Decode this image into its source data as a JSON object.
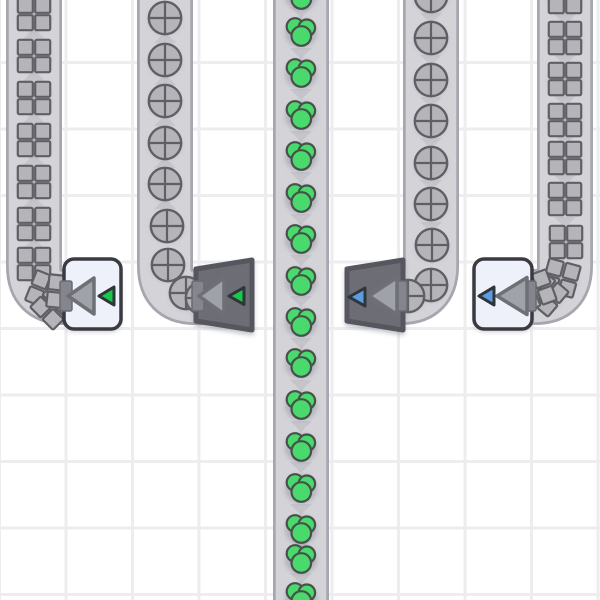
{
  "scene": {
    "name": "conveyor-factory-scene",
    "canvas": {
      "width": 600,
      "height": 600
    },
    "grid": {
      "cell_size": 66.5,
      "line_width": 3,
      "line_color": "#ededf0",
      "cell_color": "#ffffff",
      "offset_x": -2,
      "offset_y": 61
    },
    "colors": {
      "belt_border": "#a6a6ae",
      "belt_surface": "#d3d3d8",
      "chevron": "#c5c5cb",
      "item_gray_fill": "#b5b5b9",
      "item_outline": "#5f5f66",
      "berry_fill": "#49d96d",
      "berry_outline": "#47514a",
      "building_light_fill": "#eef1f9",
      "building_light_stroke": "#3a3a41",
      "building_dark_fill": "#6d6d75",
      "building_dark_stroke": "#56565e",
      "arrow_fill": "#a0a2a9",
      "arrow_stroke": "#6e7076",
      "marker_green": "#19c84b",
      "marker_blue": "#5b9ce2",
      "marker_stroke": "#30353a",
      "port_fill": "#85858d",
      "port_stroke": "#6a6a72",
      "shadow": "rgba(120,120,140,0.35)"
    },
    "belts": [
      {
        "id": "belt-squares-left",
        "item_type": "square",
        "direction": "up",
        "path": "M 34 -8 L 34 266 Q 34 297 64 297 L 76 297",
        "center_x": 34,
        "chevrons_y": [
          35,
          77,
          119,
          161,
          203,
          245
        ],
        "items": [
          {
            "y": 14
          },
          {
            "y": 56
          },
          {
            "y": 98
          },
          {
            "y": 140
          },
          {
            "y": 182
          },
          {
            "y": 224
          },
          {
            "y": 264
          },
          {
            "x": 46,
            "y": 291,
            "rot": 22
          },
          {
            "x": 53,
            "y": 307,
            "rot": 45
          },
          {
            "x": 64,
            "y": 292,
            "rot": 6
          }
        ]
      },
      {
        "id": "belt-circles-left",
        "item_type": "circle",
        "direction": "up",
        "path": "M 165 -8 L 165 266 Q 165 297 195 297 L 206 297",
        "center_x": 165,
        "chevrons_y": [
          39,
          81,
          122,
          164,
          205
        ],
        "items": [
          {
            "y": 18
          },
          {
            "y": 60
          },
          {
            "y": 101
          },
          {
            "y": 143
          },
          {
            "y": 184
          },
          {
            "x": 167,
            "y": 226
          },
          {
            "x": 168,
            "y": 265
          },
          {
            "x": 186,
            "y": 293
          },
          {
            "x": 202,
            "y": 298
          }
        ]
      },
      {
        "id": "belt-berries-center",
        "item_type": "berry",
        "direction": "down",
        "path": "M 301 -8 L 301 608",
        "center_x": 301,
        "chevrons_y": [
          11,
          52,
          93,
          135,
          176,
          218,
          259,
          300,
          342,
          384,
          425,
          466,
          508,
          543,
          577,
          588
        ],
        "items": [
          {
            "y": -6
          },
          {
            "y": 31
          },
          {
            "y": 72
          },
          {
            "y": 114
          },
          {
            "y": 155
          },
          {
            "y": 197
          },
          {
            "y": 238
          },
          {
            "y": 280
          },
          {
            "y": 321
          },
          {
            "y": 362
          },
          {
            "y": 404
          },
          {
            "y": 446
          },
          {
            "y": 487
          },
          {
            "y": 528
          },
          {
            "y": 558
          },
          {
            "y": 596
          }
        ]
      },
      {
        "id": "belt-circles-right",
        "item_type": "circle",
        "direction": "down",
        "path": "M 431 -8 L 431 266 Q 431 297 401 297 L 392 297",
        "center_x": 431,
        "chevrons_y": [
          17,
          59,
          101,
          142,
          184,
          226
        ],
        "items": [
          {
            "y": -4
          },
          {
            "y": 38
          },
          {
            "y": 80
          },
          {
            "y": 121
          },
          {
            "y": 163
          },
          {
            "y": 204
          },
          {
            "x": 432,
            "y": 245
          },
          {
            "x": 431,
            "y": 285
          },
          {
            "x": 408,
            "y": 296
          }
        ]
      },
      {
        "id": "belt-squares-right",
        "item_type": "square",
        "direction": "down",
        "path": "M 565 -8 L 565 266 Q 565 297 535 297 L 524 297",
        "center_x": 565,
        "chevrons_y": [
          18,
          59,
          100,
          139,
          179,
          221
        ],
        "items": [
          {
            "y": -3
          },
          {
            "y": 38
          },
          {
            "y": 79
          },
          {
            "y": 120
          },
          {
            "y": 158
          },
          {
            "y": 199
          },
          {
            "x": 566,
            "y": 242,
            "rot": 0
          },
          {
            "x": 561,
            "y": 278,
            "rot": 15
          },
          {
            "x": 546,
            "y": 294,
            "rot": 40
          },
          {
            "x": 536,
            "y": 290,
            "rot": 70
          }
        ]
      }
    ],
    "buildings": [
      {
        "id": "building-white-green",
        "style": "light",
        "x": 64,
        "y": 259,
        "w": 57,
        "h": 70,
        "port_side": "left",
        "marker": "green",
        "big_arrow": {
          "tip_x": 68,
          "cy": 296,
          "w": 26,
          "h": 36
        },
        "small_arrow": {
          "tip_x": 99,
          "cy": 296,
          "w": 15,
          "h": 18
        }
      },
      {
        "id": "building-dark-green",
        "style": "dark",
        "x": 196,
        "y": 260,
        "w": 56,
        "h": 70,
        "taper": 9,
        "port_side": "left",
        "marker": "green",
        "big_arrow": {
          "tip_x": 199,
          "cy": 296,
          "w": 25,
          "h": 36
        },
        "small_arrow": {
          "tip_x": 229,
          "cy": 296,
          "w": 15,
          "h": 17
        }
      },
      {
        "id": "building-dark-blue",
        "style": "dark",
        "x": 347,
        "y": 260,
        "w": 56,
        "h": 70,
        "taper": 9,
        "port_side": "right",
        "marker": "blue",
        "big_arrow": {
          "tip_x": 369,
          "cy": 296,
          "w": 28,
          "h": 37
        },
        "small_arrow": {
          "tip_x": 349,
          "cy": 297,
          "w": 16,
          "h": 18
        }
      },
      {
        "id": "building-white-blue",
        "style": "light",
        "x": 474,
        "y": 259,
        "w": 58,
        "h": 70,
        "port_side": "right",
        "marker": "blue",
        "big_arrow": {
          "tip_x": 497,
          "cy": 296,
          "w": 30,
          "h": 37
        },
        "small_arrow": {
          "tip_x": 479,
          "cy": 296,
          "w": 15,
          "h": 18
        }
      }
    ]
  }
}
